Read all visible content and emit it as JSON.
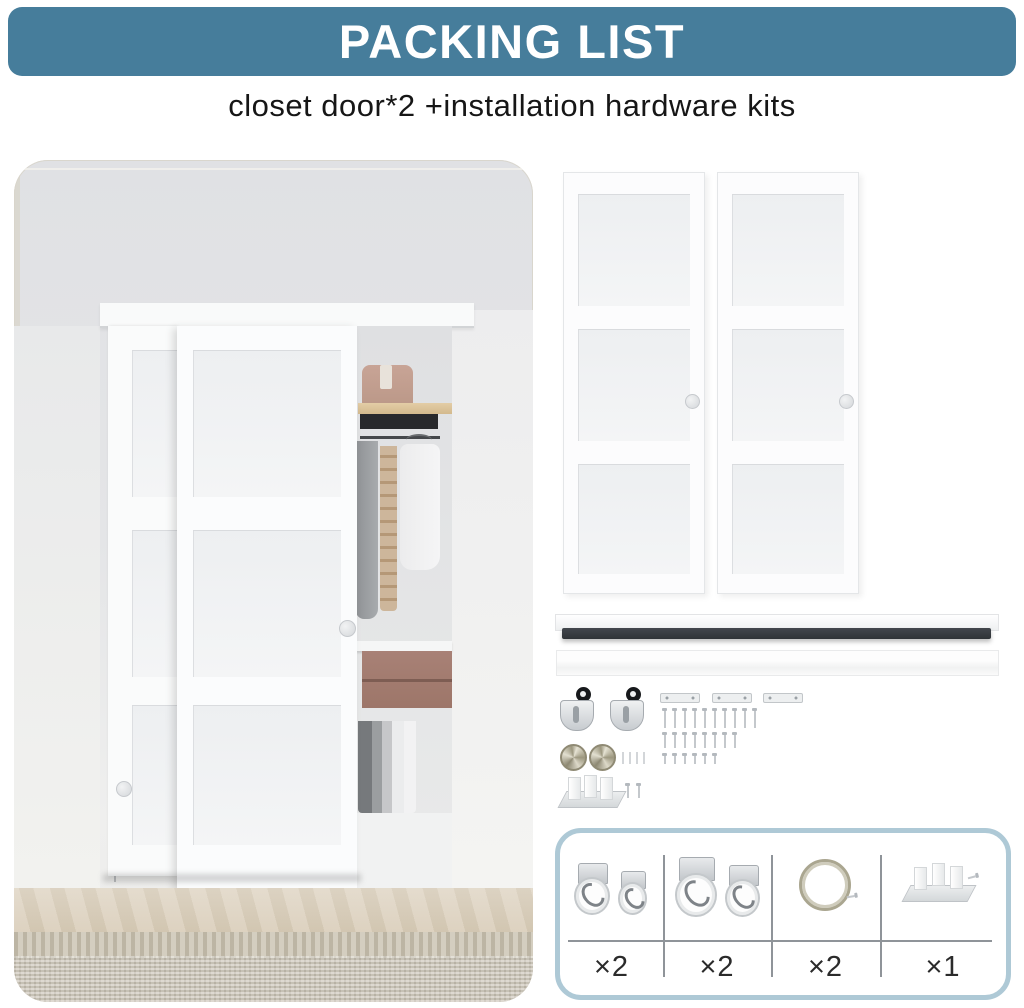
{
  "header": {
    "title": "PACKING LIST",
    "banner_color": "#467d9b",
    "text_color": "#ffffff"
  },
  "subtitle": "closet door*2 +installation hardware kits",
  "scene": {
    "left_photo": "closet with two sliding frosted 3-lite doors, open side showing shelf, hat box, hanging clothes, drawers and pants, herringbone floor and rug",
    "right_panels": {
      "door_count": 2,
      "lites_per_door": 3
    }
  },
  "tracks": {
    "top_track_color": "#33373c",
    "bottom_track_color": "#f4f5f5"
  },
  "hardware": {
    "top_rollers": 2,
    "mounting_plates": 3,
    "screw_rows": [
      10,
      8,
      6
    ],
    "pins": 4,
    "door_pulls": 2,
    "floor_guide": 1,
    "guide_screws": 2
  },
  "packing_table": {
    "border_color": "#aec9d6",
    "items": [
      {
        "name": "bottom-roller-small-pair",
        "qty": "×2"
      },
      {
        "name": "bottom-roller-large-pair",
        "qty": "×2"
      },
      {
        "name": "round-finger-pull",
        "qty": "×2"
      },
      {
        "name": "floor-guide-kit",
        "qty": "×1"
      }
    ]
  }
}
